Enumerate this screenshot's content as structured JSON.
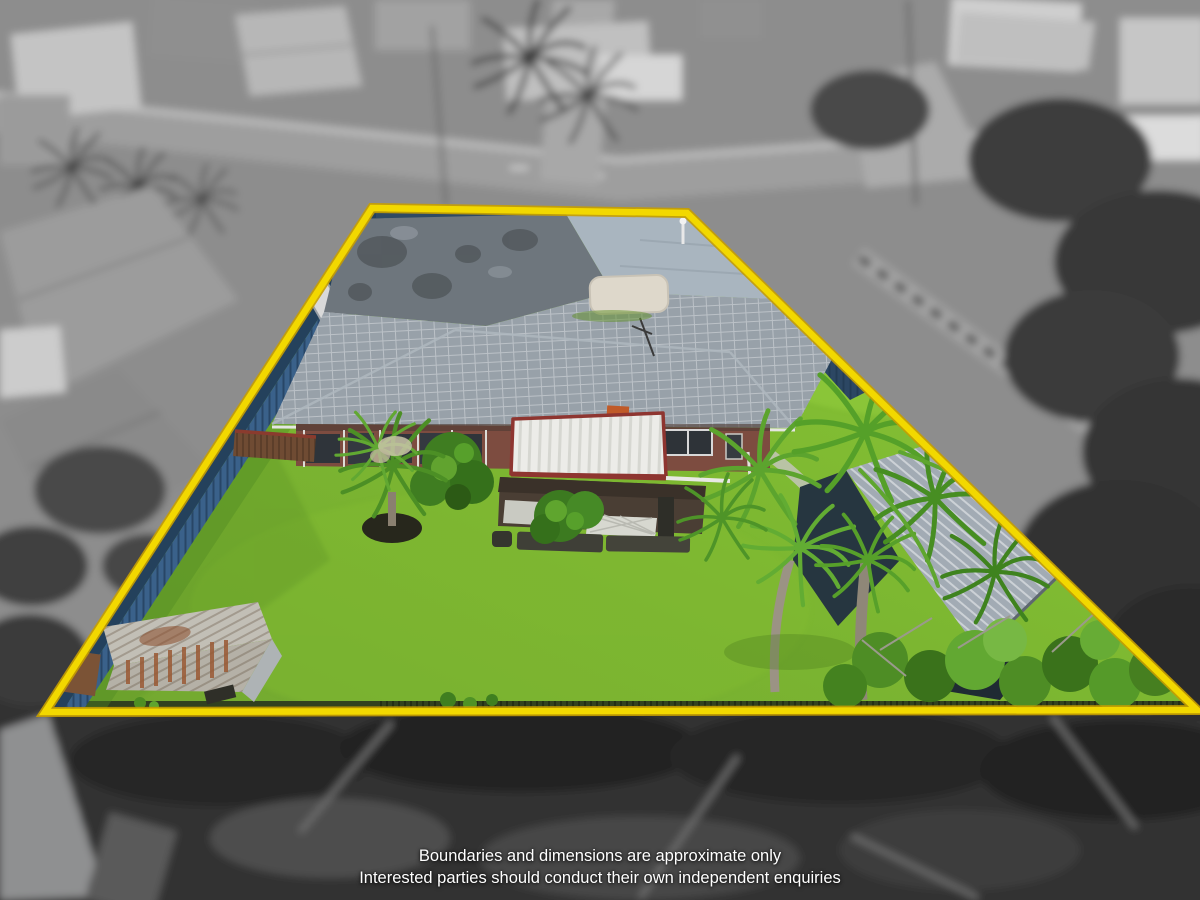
{
  "scene": {
    "type": "aerial-property-marketing-photo",
    "description": "Drone aerial of a suburban lot highlighted in colour with a yellow boundary outline; surrounding neighbourhood desaturated to grayscale",
    "boundary": {
      "points": "372,208 687,213 1197,710 45,712",
      "color": "#F2D800",
      "edge_color": "#C79F00"
    },
    "disclaimer": {
      "line1": "Boundaries and dimensions are approximate only",
      "line2": "Interested parties should conduct their own independent enquiries"
    },
    "palette": {
      "boundary": "#F2D800",
      "boundaryEdge": "#C79F00",
      "lawn": "#79B52F",
      "lawnLight": "#92CC3E",
      "lawnDark": "#5E9427",
      "fence": "#3A618A",
      "fenceDark": "#24415C",
      "roofDark": "#6E767D",
      "roofLight": "#A9B5BF",
      "roofTile": "#98A1A9",
      "brick": "#7D4C40",
      "pergola": "#ECECE8",
      "pergolaTrim": "#8E3530",
      "deck": "#4A3E34",
      "lattice": "#D7D8D0",
      "shedSilver": "#C2BFB6",
      "shedRust": "#9A5A34",
      "flatRoof": "#A2ABB4",
      "flatWall": "#263640",
      "palm": "#55A029",
      "palmDark": "#3F831E",
      "slab": "#DED8CB",
      "bg": "#8D8D8D",
      "bgDark": "#323232",
      "road": "#9E9E9E",
      "text": "#FFFFFF"
    },
    "features": [
      "main house with tiled hip roof",
      "white pergola with red trim",
      "timber deck with lattice",
      "rusty garden shed",
      "secondary building under palms",
      "colorbond fence",
      "palm trees",
      "lawn",
      "concrete slab"
    ]
  }
}
